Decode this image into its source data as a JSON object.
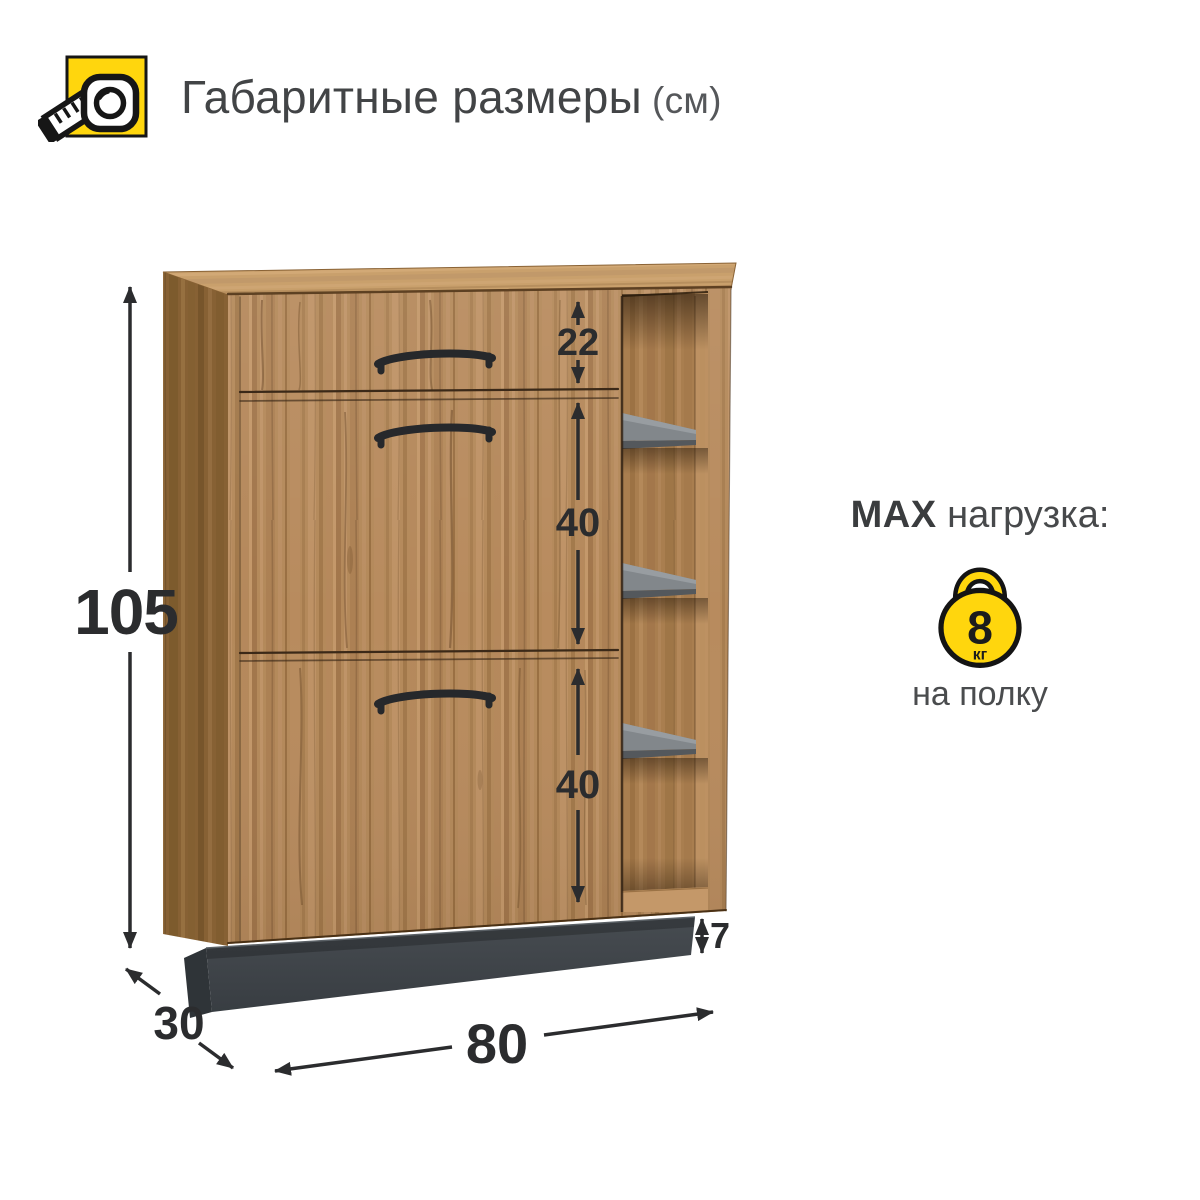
{
  "header": {
    "title": "Габаритные размеры",
    "unit": "(см)"
  },
  "diagram": {
    "type": "furniture-dimension-diagram",
    "unit": "см",
    "height": "105",
    "width": "80",
    "depth": "30",
    "drawer_height": "22",
    "upper_door_height": "40",
    "lower_door_height": "40",
    "plinth_height": "7"
  },
  "max_load": {
    "prefix": "MAX",
    "label": "нагрузка:",
    "value": "8",
    "unit": "кг",
    "note": "на полку"
  },
  "colors": {
    "accent_yellow": "#ffd60d",
    "wood_front": "#b4895a",
    "wood_side": "#906838",
    "wood_top": "#c9a06c",
    "shelf_gray": "#82878b",
    "plinth_gray": "#42474c",
    "ink": "#2b2c2e"
  }
}
